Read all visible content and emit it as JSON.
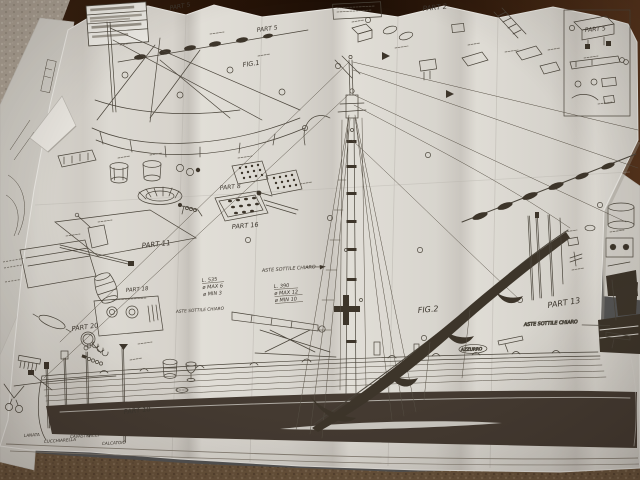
{
  "plan": {
    "figures": {
      "fig1": "FIG.1",
      "fig2": "FIG.2"
    },
    "part_labels": {
      "part2": "PART 2",
      "part5_a": "PART 5",
      "part5_b": "PART 5",
      "part5_c": "PART 5",
      "part8": "PART 8",
      "part10": "PART 10",
      "part11": "PART 11",
      "part13": "PART 13",
      "part16": "PART 16",
      "part18": "PART 18",
      "part20": "PART 20"
    },
    "dimension_notes": {
      "note1": {
        "length": "L. 535",
        "dmax": "ø MAX 6",
        "dmin": "ø MIN 3"
      },
      "note2": {
        "length": "L. 390",
        "dmax": "ø MAX 12",
        "dmin": "ø MIN 10"
      }
    },
    "annotations": {
      "aste_a": "ASTE SOTTILE CHIARO",
      "aste_b": "ASTE SOTTILE CHIARO",
      "aste_c": "ASTE SOTTILE CHIARO",
      "color_callout": "AZZURRO"
    },
    "tool_labels": [
      "LANATA",
      "CUCCHIARELLA",
      "CAVASTRACCI",
      "CALCATOIO"
    ]
  },
  "colors": {
    "paper": "#d7d4cd",
    "ink": "#4a443a",
    "hull_dark": "#443b31",
    "sail_dark": "#3e362c",
    "carpet_brown": "#6b553d",
    "carpet_grey": "#a89e91",
    "dark_wood": "#2a1609"
  }
}
